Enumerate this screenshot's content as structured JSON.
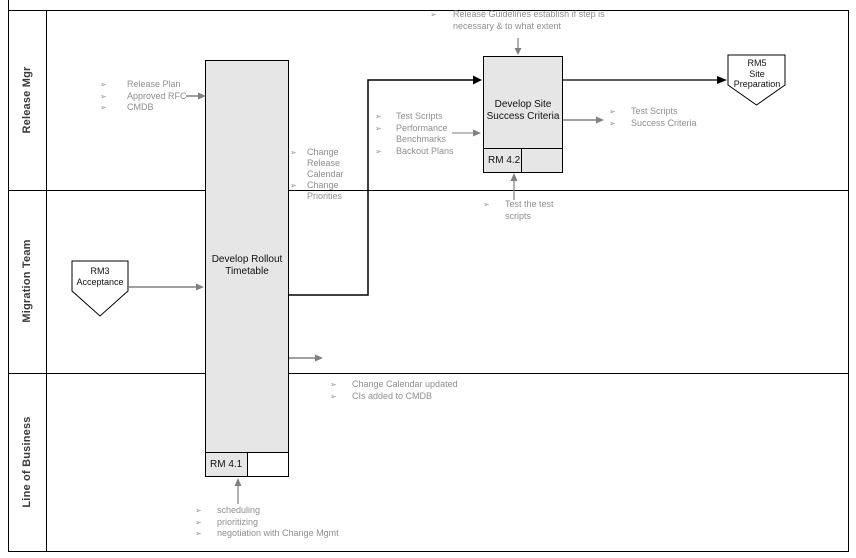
{
  "bullet_glyph": "➢",
  "lanes": [
    "Release Mgr",
    "Migration Team",
    "Line of Business"
  ],
  "nodes": {
    "rollout_title": "Develop Rollout Timetable",
    "rollout_tag": "RM 4.1",
    "success_title": "Develop Site Success Criteria",
    "success_tag": "RM 4.2",
    "rm3_lines": [
      "RM3",
      "Acceptance"
    ],
    "rm5_lines": [
      "RM5",
      "Site",
      "Preparation"
    ]
  },
  "annotations": {
    "guidelines": [
      "Release Guidelines establish if step is necessary & to what extent"
    ],
    "rollout_inputs": [
      "Release Plan",
      "Approved RFC",
      "CMDB"
    ],
    "change_outputs": [
      "Change Release Calendar",
      "Change Priorities"
    ],
    "success_inputs": [
      "Test Scripts",
      "Performance Benchmarks",
      "Backout Plans"
    ],
    "success_outputs": [
      "Test Scripts",
      "Success Criteria"
    ],
    "test_note": [
      "Test the test scripts"
    ],
    "lob_outputs": [
      "Change Calendar updated",
      "CIs added to CMDB"
    ],
    "rollout_activities": [
      "scheduling",
      "prioritizing",
      "negotiation with Change Mgmt"
    ]
  },
  "colors": {
    "box_fill": "#e6e6e6",
    "border_black": "#000000",
    "arrow_gray": "#808080",
    "annotation_text": "#8f8f8f"
  }
}
